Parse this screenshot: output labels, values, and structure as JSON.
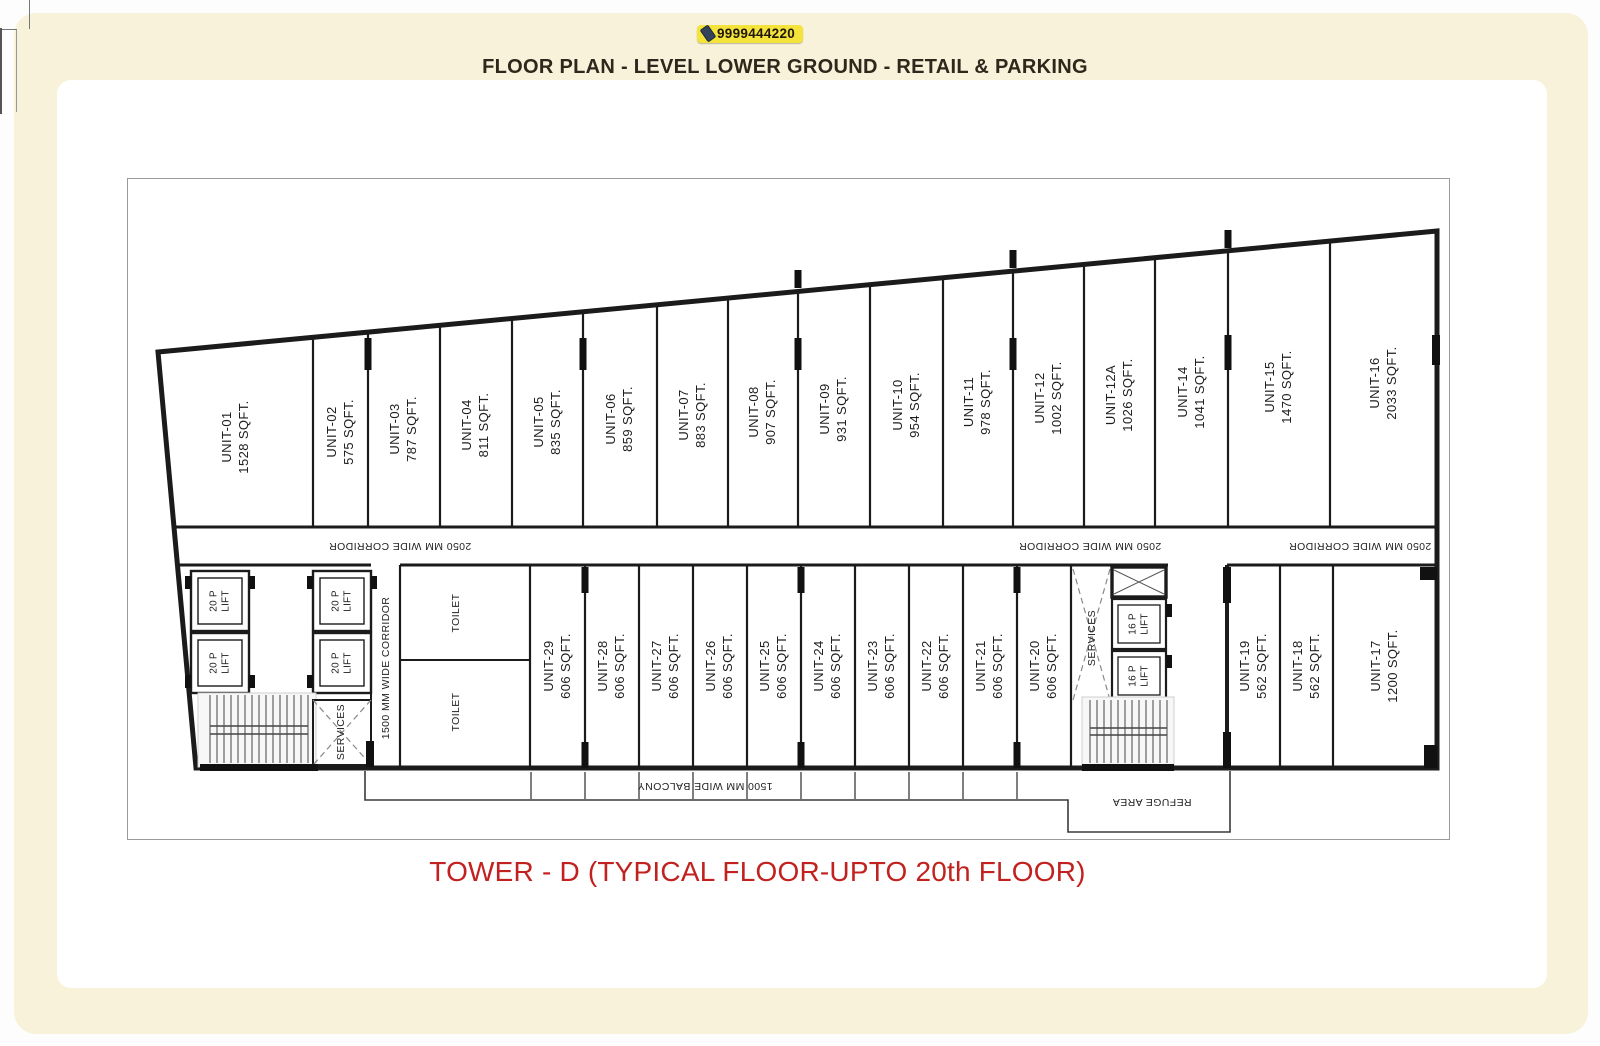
{
  "header": {
    "phone": "9999444220",
    "title": "FLOOR PLAN - LEVEL LOWER GROUND - RETAIL & PARKING"
  },
  "footer": {
    "caption": "TOWER - D (TYPICAL FLOOR-UPTO 20th  FLOOR)"
  },
  "colors": {
    "page_bg": "#f8f2da",
    "panel_bg": "#ffffff",
    "title_text": "#30261c",
    "caption_text": "#c2221f",
    "badge_bg": "#f3e33b",
    "wall": "#1b1b1b"
  },
  "plan": {
    "top_units": [
      {
        "name": "UNIT-01",
        "area": "1528 SQFT."
      },
      {
        "name": "UNIT-02",
        "area": "575 SQFT."
      },
      {
        "name": "UNIT-03",
        "area": "787 SQFT."
      },
      {
        "name": "UNIT-04",
        "area": "811 SQFT."
      },
      {
        "name": "UNIT-05",
        "area": "835 SQFT."
      },
      {
        "name": "UNIT-06",
        "area": "859 SQFT."
      },
      {
        "name": "UNIT-07",
        "area": "883 SQFT."
      },
      {
        "name": "UNIT-08",
        "area": "907 SQFT."
      },
      {
        "name": "UNIT-09",
        "area": "931 SQFT."
      },
      {
        "name": "UNIT-10",
        "area": "954 SQFT."
      },
      {
        "name": "UNIT-11",
        "area": "978 SQFT."
      },
      {
        "name": "UNIT-12",
        "area": "1002 SQFT."
      },
      {
        "name": "UNIT-12A",
        "area": "1026 SQFT."
      },
      {
        "name": "UNIT-14",
        "area": "1041 SQFT."
      },
      {
        "name": "UNIT-15",
        "area": "1470 SQFT."
      },
      {
        "name": "UNIT-16",
        "area": "2033 SQFT."
      }
    ],
    "bottom_units": [
      {
        "name": "UNIT-29",
        "area": "606 SQFT."
      },
      {
        "name": "UNIT-28",
        "area": "606 SQFT."
      },
      {
        "name": "UNIT-27",
        "area": "606 SQFT."
      },
      {
        "name": "UNIT-26",
        "area": "606 SQFT."
      },
      {
        "name": "UNIT-25",
        "area": "606 SQFT."
      },
      {
        "name": "UNIT-24",
        "area": "606 SQFT."
      },
      {
        "name": "UNIT-23",
        "area": "606 SQFT."
      },
      {
        "name": "UNIT-22",
        "area": "606 SQFT."
      },
      {
        "name": "UNIT-21",
        "area": "606 SQFT."
      },
      {
        "name": "UNIT-20",
        "area": "606 SQFT."
      },
      {
        "name": "UNIT-19",
        "area": "562 SQFT."
      },
      {
        "name": "UNIT-18",
        "area": "562 SQFT."
      },
      {
        "name": "UNIT-17",
        "area": "1200 SQFT."
      }
    ],
    "corridor_labels": [
      "2050 MM WIDE CORRIDOR",
      "2050 MM WIDE CORRIDOR",
      "2050 MM WIDE CORRIDOR"
    ],
    "vertical_corridor_label": "1500 MM WIDE CORRIDOR",
    "balcony_label": "1500 MM WIDE BALCONY",
    "refuge_label": "REFUGE AREA",
    "toilets": [
      "TOILET",
      "TOILET"
    ],
    "services": [
      "SERVICES",
      "SERVICES"
    ],
    "lifts_20p": [
      {
        "line1": "20 P",
        "line2": "LIFT"
      },
      {
        "line1": "20 P",
        "line2": "LIFT"
      },
      {
        "line1": "20 P",
        "line2": "LIFT"
      },
      {
        "line1": "20 P",
        "line2": "LIFT"
      }
    ],
    "lifts_16p": [
      {
        "line1": "16 P",
        "line2": "LIFT"
      },
      {
        "line1": "16 P",
        "line2": "LIFT"
      }
    ]
  }
}
